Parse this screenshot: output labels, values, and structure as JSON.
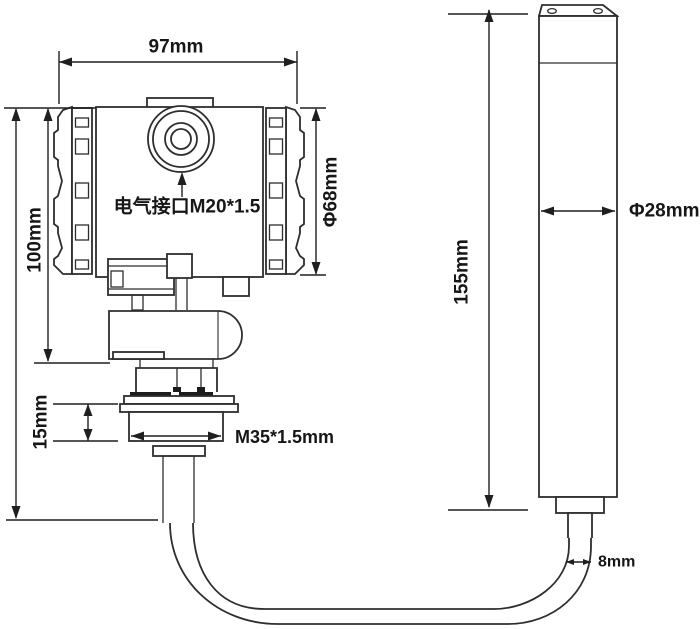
{
  "drawing": {
    "kind": "technical-dimension-drawing",
    "subject": "pressure level transmitter with submersible probe",
    "colors": {
      "background": "#ffffff",
      "line": "#2e2e2e",
      "text": "#161616"
    },
    "labels": {
      "top_width": "97mm",
      "housing_height": "100mm",
      "housing_diameter": "Φ68mm",
      "electrical_port": "电气接口M20*1.5",
      "thread_length": "15mm",
      "thread_spec": "M35*1.5mm",
      "probe_length": "155mm",
      "probe_diameter": "Φ28mm",
      "cable_diameter": "8mm"
    }
  }
}
